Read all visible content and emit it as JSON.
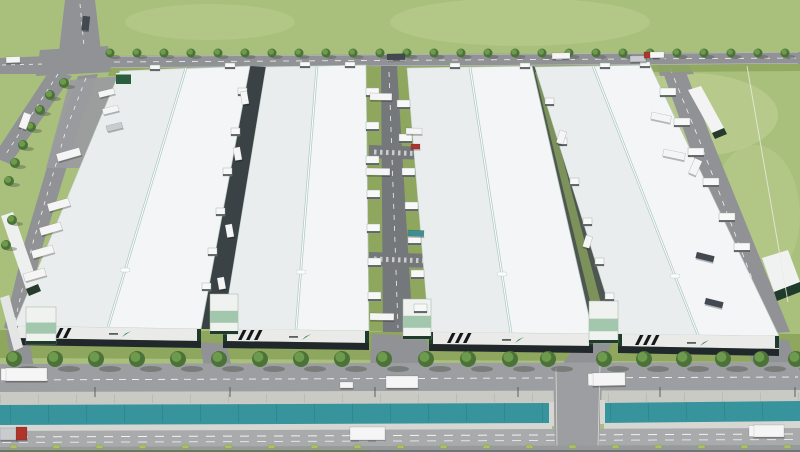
{
  "alt": "Aerial 3D architectural rendering of an industrial logistics park: four large white warehouse buildings with ridge skylights, internal service roads with loading docks and trucks, a tree-lined frontage road, a drainage canal and a main road at the front, surrounded by green fields and a road intersection at the top left",
  "palette": {
    "grass": "#a9c07c",
    "grass_light": "#c6d49c",
    "lawn": "#8ea65e",
    "road": "#909295",
    "road_internal": "#74787b",
    "frontage_road": "#9c9ea1",
    "main_road": "#a8aaac",
    "berm": "#cacac5",
    "lip": "#d6d6d2",
    "water": "#37939c",
    "water_dark": "#2a7e87",
    "roof": "#f3f5f6",
    "roof_shade": "#e3e8ea",
    "ridge": "#b4cbc5",
    "facade_white": "#eaebe8",
    "facade_dark": "#20282b",
    "end_green": "#1e3b2b",
    "accent_green": "#2e7d4f",
    "glass_green": "#a3c7ac",
    "tree": "#4b7338",
    "tree_light": "#74a152",
    "shadow": "#4e554b",
    "white": "#f5f5f5",
    "gray": "#c8ccce",
    "red": "#ae352c",
    "dark": "#424950",
    "teal": "#3f8e91",
    "dash": "#f2f2f2",
    "bush": "#aac263",
    "curb": "#97999b",
    "bottom": "#717477",
    "stripe": "#14181a",
    "pad": "#9a9c9e",
    "alley1": "#3a4245",
    "alley2": "#4d5651",
    "shed_base": "#273a2c"
  },
  "scene": {
    "buildings": [
      {
        "id": 1,
        "roof": "120,71 250,66 201,329 14,326",
        "ridge": [
          186,
          68,
          108,
          327
        ],
        "vent": [
          125,
          270
        ],
        "facade": "14,326 201,329 201,341 14,338",
        "base": "14,338 201,341 201,348 14,345",
        "ends": [
          [
            14,
            326
          ],
          [
            197,
            329
          ]
        ],
        "stripes": [
          52,
          328
        ],
        "logo": [
          122,
          332
        ],
        "annex": [
          26,
          307,
          30,
          37
        ]
      },
      {
        "id": 2,
        "roof": "266,67 366,65 369,331 223,329",
        "ridge": [
          317,
          66,
          296,
          330
        ],
        "vent": [
          301,
          272
        ],
        "facade": "223,329 369,331 369,343 223,341",
        "base": "223,341 369,343 369,350 223,348",
        "ends": [
          [
            223,
            329
          ],
          [
            365,
            331
          ]
        ],
        "stripes": [
          243,
          330
        ],
        "logo": [
          302,
          335
        ],
        "annex": [
          210,
          294,
          28,
          40
        ]
      },
      {
        "id": 3,
        "roof": "407,68 532,66 593,334 429,332",
        "ridge": [
          470,
          67,
          511,
          333
        ],
        "vent": [
          502,
          274
        ],
        "facade": "429,332 593,334 593,346 429,344",
        "base": "429,344 593,346 593,353 429,351",
        "ends": [
          [
            429,
            332
          ],
          [
            589,
            334
          ]
        ],
        "stripes": [
          452,
          333
        ],
        "logo": [
          515,
          338
        ],
        "annex": [
          403,
          299,
          28,
          40
        ]
      },
      {
        "id": 4,
        "roof": "535,67 650,65 779,336 618,334",
        "ridge": [
          593,
          66,
          698,
          335
        ],
        "vent": [
          675,
          276
        ],
        "facade": "618,334 779,336 779,349 618,346",
        "base": "618,346 779,349 779,356 618,353",
        "ends": [
          [
            618,
            334
          ],
          [
            775,
            336
          ]
        ],
        "stripes": [
          640,
          335
        ],
        "logo": [
          700,
          341
        ],
        "annex": [
          589,
          301,
          29,
          42
        ]
      }
    ],
    "docks": [
      {
        "name": "loading-dock-central-west",
        "size": [
          13,
          9
        ],
        "pts": [
          [
            366,
            88
          ],
          [
            366,
            122
          ],
          [
            366,
            156
          ],
          [
            367,
            190
          ],
          [
            367,
            224
          ],
          [
            368,
            258
          ],
          [
            368,
            292
          ]
        ]
      },
      {
        "name": "loading-dock-central-east",
        "size": [
          13,
          9
        ],
        "pts": [
          [
            397,
            100
          ],
          [
            399,
            134
          ],
          [
            402,
            168
          ],
          [
            405,
            202
          ],
          [
            408,
            236
          ],
          [
            411,
            270
          ],
          [
            414,
            304
          ]
        ]
      },
      {
        "name": "loading-dock-alley-west",
        "size": [
          9,
          8
        ],
        "pts": [
          [
            238,
            88
          ],
          [
            231,
            128
          ],
          [
            223,
            168
          ],
          [
            216,
            208
          ],
          [
            208,
            248
          ],
          [
            202,
            283
          ]
        ]
      },
      {
        "name": "loading-dock-alley-east",
        "size": [
          9,
          8
        ],
        "pts": [
          [
            545,
            98
          ],
          [
            558,
            138
          ],
          [
            570,
            178
          ],
          [
            583,
            218
          ],
          [
            595,
            258
          ],
          [
            605,
            293
          ]
        ]
      },
      {
        "name": "loading-dock-east-side",
        "size": [
          16,
          9
        ],
        "pts": [
          [
            660,
            88
          ],
          [
            674,
            118
          ],
          [
            688,
            148
          ],
          [
            703,
            178
          ],
          [
            719,
            213
          ],
          [
            734,
            243
          ]
        ]
      },
      {
        "name": "loading-dock-north",
        "size": [
          10,
          6
        ],
        "pts": [
          [
            150,
            65
          ],
          [
            225,
            63
          ],
          [
            300,
            62
          ],
          [
            345,
            62
          ],
          [
            450,
            63
          ],
          [
            520,
            63
          ],
          [
            600,
            63
          ],
          [
            640,
            62
          ]
        ]
      }
    ],
    "trees_top": {
      "y": 53,
      "r": 4.5,
      "xs": [
        110,
        137,
        164,
        191,
        218,
        245,
        272,
        299,
        326,
        353,
        380,
        407,
        434,
        461,
        488,
        515,
        542,
        569,
        596,
        623,
        650,
        677,
        704,
        731,
        758,
        785
      ]
    },
    "trees_west": {
      "r": 5,
      "pts": [
        [
          64,
          83
        ],
        [
          50,
          95
        ],
        [
          40,
          110
        ],
        [
          31,
          127
        ],
        [
          23,
          145
        ],
        [
          15,
          163
        ],
        [
          9,
          181
        ],
        [
          12,
          220
        ],
        [
          6,
          245
        ]
      ]
    },
    "trees_bottom": {
      "y": 359,
      "r": 8,
      "xs": [
        14,
        55,
        96,
        137,
        178,
        219,
        260,
        301,
        342,
        384,
        426,
        468,
        510,
        548,
        604,
        644,
        684,
        723,
        761,
        796
      ]
    },
    "bushes": {
      "y": 445,
      "xs": [
        10,
        53,
        96,
        139,
        182,
        225,
        268,
        311,
        354,
        397,
        440,
        483,
        526,
        569,
        612,
        655,
        698,
        741,
        784
      ]
    },
    "lampposts": {
      "y": 388,
      "xs": [
        95,
        230,
        375,
        518,
        660,
        795
      ]
    },
    "trucks": [
      [
        6,
        57,
        14,
        6,
        -2,
        "white",
        null
      ],
      [
        83,
        16,
        7,
        14,
        6,
        "dark",
        null
      ],
      [
        387,
        54,
        18,
        6,
        -1,
        "dark",
        null
      ],
      [
        552,
        53,
        18,
        6,
        -1,
        "white",
        null
      ],
      [
        630,
        56,
        16,
        6,
        -1,
        "gray",
        null
      ],
      [
        649,
        52,
        15,
        6,
        -1,
        "white",
        null
      ],
      [
        644,
        52,
        6,
        6,
        -1,
        "red",
        null
      ],
      [
        24,
        112,
        8,
        16,
        20,
        "white",
        null
      ],
      [
        98,
        92,
        16,
        6,
        -14,
        "white",
        null
      ],
      [
        102,
        109,
        16,
        6,
        -14,
        "white",
        null
      ],
      [
        106,
        126,
        16,
        6,
        -14,
        "gray",
        null
      ],
      [
        56,
        154,
        24,
        8,
        -16,
        "white",
        null
      ],
      [
        47,
        204,
        22,
        8,
        -16,
        "white",
        null
      ],
      [
        39,
        228,
        22,
        8,
        -16,
        "white",
        null
      ],
      [
        31,
        251,
        22,
        8,
        -16,
        "white",
        null
      ],
      [
        23,
        274,
        22,
        8,
        -16,
        "white",
        null
      ],
      [
        370,
        93,
        22,
        7,
        1,
        "white",
        null
      ],
      [
        406,
        128,
        16,
        6,
        1,
        "white",
        null
      ],
      [
        411,
        144,
        9,
        5,
        0,
        "red",
        null
      ],
      [
        366,
        168,
        24,
        7,
        1,
        "white",
        null
      ],
      [
        408,
        230,
        16,
        6,
        2,
        "teal",
        null
      ],
      [
        370,
        313,
        24,
        7,
        1,
        "white",
        null
      ],
      [
        240,
        92,
        7,
        13,
        -10,
        "white",
        null
      ],
      [
        233,
        148,
        7,
        13,
        -10,
        "white",
        null
      ],
      [
        225,
        225,
        7,
        13,
        -10,
        "white",
        null
      ],
      [
        217,
        278,
        7,
        12,
        -10,
        "white",
        null
      ],
      [
        560,
        130,
        7,
        13,
        17,
        "white",
        null
      ],
      [
        586,
        235,
        7,
        12,
        17,
        "white",
        null
      ],
      [
        652,
        112,
        20,
        7,
        12,
        "white",
        null
      ],
      [
        664,
        149,
        22,
        7,
        12,
        "white",
        null
      ],
      [
        697,
        252,
        18,
        6,
        14,
        "dark",
        null
      ],
      [
        706,
        298,
        18,
        6,
        14,
        "dark",
        null
      ],
      [
        695,
        158,
        8,
        16,
        24,
        "white",
        null
      ],
      [
        5,
        368,
        42,
        13,
        0,
        "white",
        "white"
      ],
      [
        386,
        376,
        32,
        12,
        0,
        "white",
        null
      ],
      [
        592,
        373,
        33,
        13,
        -1,
        "white",
        "white"
      ],
      [
        340,
        382,
        13,
        6,
        0,
        "white",
        null
      ],
      [
        0,
        428,
        17,
        12,
        0,
        "gray",
        null
      ],
      [
        16,
        427,
        11,
        13,
        0,
        "red",
        null
      ],
      [
        350,
        427,
        35,
        13,
        0,
        "white",
        null
      ],
      [
        753,
        425,
        31,
        12,
        0,
        "white",
        "white"
      ]
    ]
  }
}
